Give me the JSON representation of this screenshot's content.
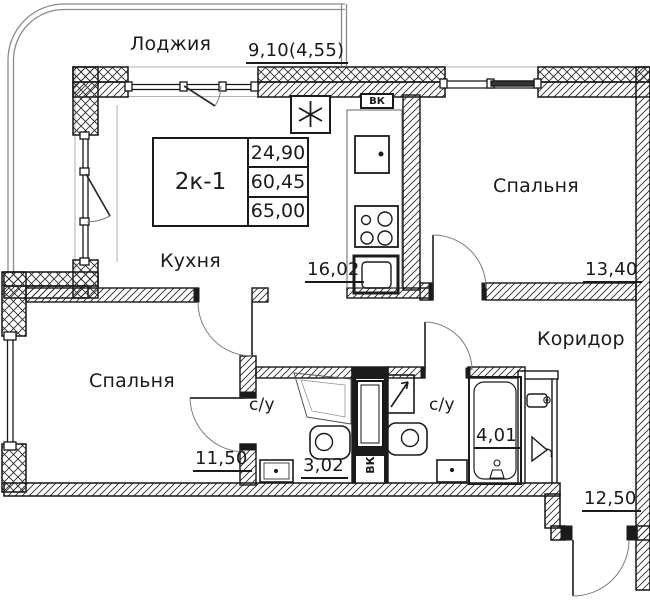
{
  "plan": {
    "title_block": {
      "unit": "2к-1",
      "values": [
        "24,90",
        "60,45",
        "65,00"
      ]
    },
    "loggia": {
      "label": "Лоджия",
      "dim": "9,10(4,55)"
    },
    "kitchen": {
      "label": "Кухня",
      "area": "16,02"
    },
    "bedroom_right": {
      "label": "Спальня",
      "area": "13,40"
    },
    "bedroom_left": {
      "label": "Спальня",
      "area": "11,50"
    },
    "bathroom_left": {
      "label": "с/у",
      "area": "3,02"
    },
    "bathroom_right": {
      "label": "с/у",
      "area": "4,01"
    },
    "corridor": {
      "label": "Коридор",
      "area": "12,50"
    },
    "duct": {
      "label": "ВК"
    }
  }
}
